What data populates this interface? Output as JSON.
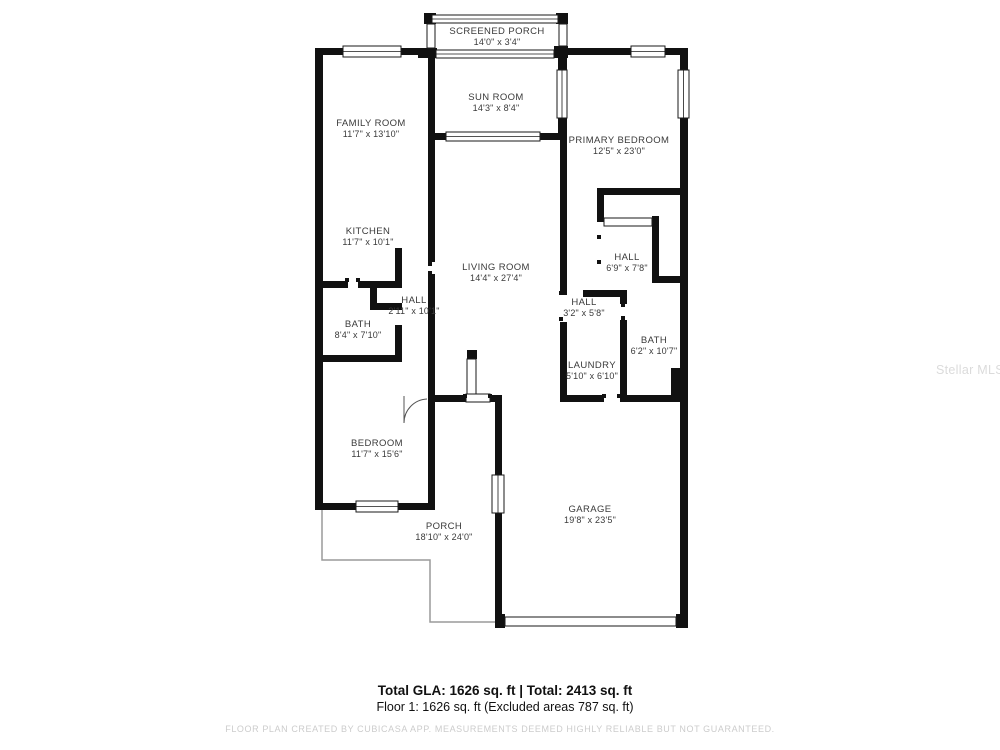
{
  "floor_plan": {
    "rooms": [
      {
        "name": "SCREENED PORCH",
        "dims": "14'0\" x 3'4\""
      },
      {
        "name": "SUN ROOM",
        "dims": "14'3\" x 8'4\""
      },
      {
        "name": "FAMILY ROOM",
        "dims": "11'7\" x 13'10\""
      },
      {
        "name": "PRIMARY BEDROOM",
        "dims": "12'5\" x 23'0\""
      },
      {
        "name": "KITCHEN",
        "dims": "11'7\" x 10'1\""
      },
      {
        "name": "LIVING ROOM",
        "dims": "14'4\" x 27'4\""
      },
      {
        "name": "HALL",
        "dims": "6'9\" x 7'8\""
      },
      {
        "name": "HALL",
        "dims": "3'2\" x 5'8\""
      },
      {
        "name": "HALL",
        "dims": "2'11\" x 10'1\""
      },
      {
        "name": "BATH",
        "dims": "8'4\" x 7'10\""
      },
      {
        "name": "BATH",
        "dims": "6'2\" x 10'7\""
      },
      {
        "name": "LAUNDRY",
        "dims": "5'10\" x 6'10\""
      },
      {
        "name": "BEDROOM",
        "dims": "11'7\" x 15'6\""
      },
      {
        "name": "PORCH",
        "dims": "18'10\" x 24'0\""
      },
      {
        "name": "GARAGE",
        "dims": "19'8\" x 23'5\""
      }
    ],
    "summary": {
      "line1": "Total GLA: 1626 sq. ft | Total: 2413 sq. ft",
      "line2": "Floor 1: 1626 sq. ft (Excluded areas 787 sq. ft)"
    },
    "disclaimer": "FLOOR PLAN CREATED BY CUBICASA APP. MEASUREMENTS DEEMED HIGHLY RELIABLE BUT NOT GUARANTEED.",
    "watermark": "Stellar MLS",
    "colors": {
      "wall": "#111111",
      "label": "#3a3a3a",
      "porch_outline": "#9a9a9a",
      "disclaimer": "#cccccc",
      "watermark": "#dbdbdb"
    }
  }
}
